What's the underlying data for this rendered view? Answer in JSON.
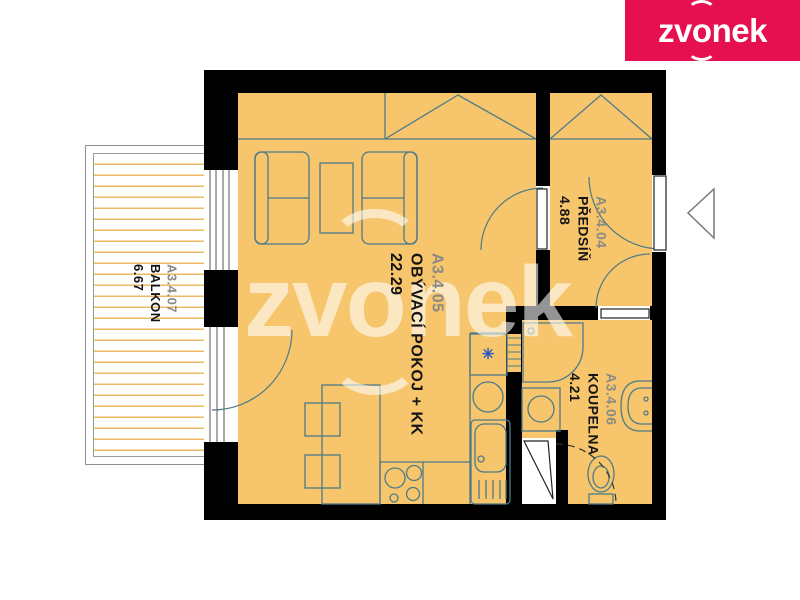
{
  "logo": {
    "part1": "zv",
    "part2": "o",
    "part3": "nek"
  },
  "watermark": {
    "part1": "zv",
    "part2": "o",
    "part3": "nek"
  },
  "rooms": {
    "balkon": {
      "code": "A3.4.07",
      "name": "BALKON",
      "area": "6.67"
    },
    "obyvaci": {
      "code": "A3.4.05",
      "name": "OBÝVACÍ POKOJ + KK",
      "area": "22.29"
    },
    "predsin": {
      "code": "A3.4.04",
      "name": "PŘEDSÍŇ",
      "area": "4.88"
    },
    "koupelna": {
      "code": "A3.4.06",
      "name": "KOUPELNA",
      "area": "4.21"
    }
  },
  "icons": {
    "freezer_star": "✳",
    "entrance_arrow": "left-pointing-triangle"
  },
  "colors": {
    "floor": "#f6c56c",
    "wall": "#000000",
    "furniture_line": "#4e7b88",
    "balcony_hatch": "#ecb964",
    "logo_bg": "#e60f4f",
    "logo_text": "#ffffff",
    "label_code": "#8a8a84",
    "label_text": "#141414",
    "freezer_star": "#2456c4"
  }
}
